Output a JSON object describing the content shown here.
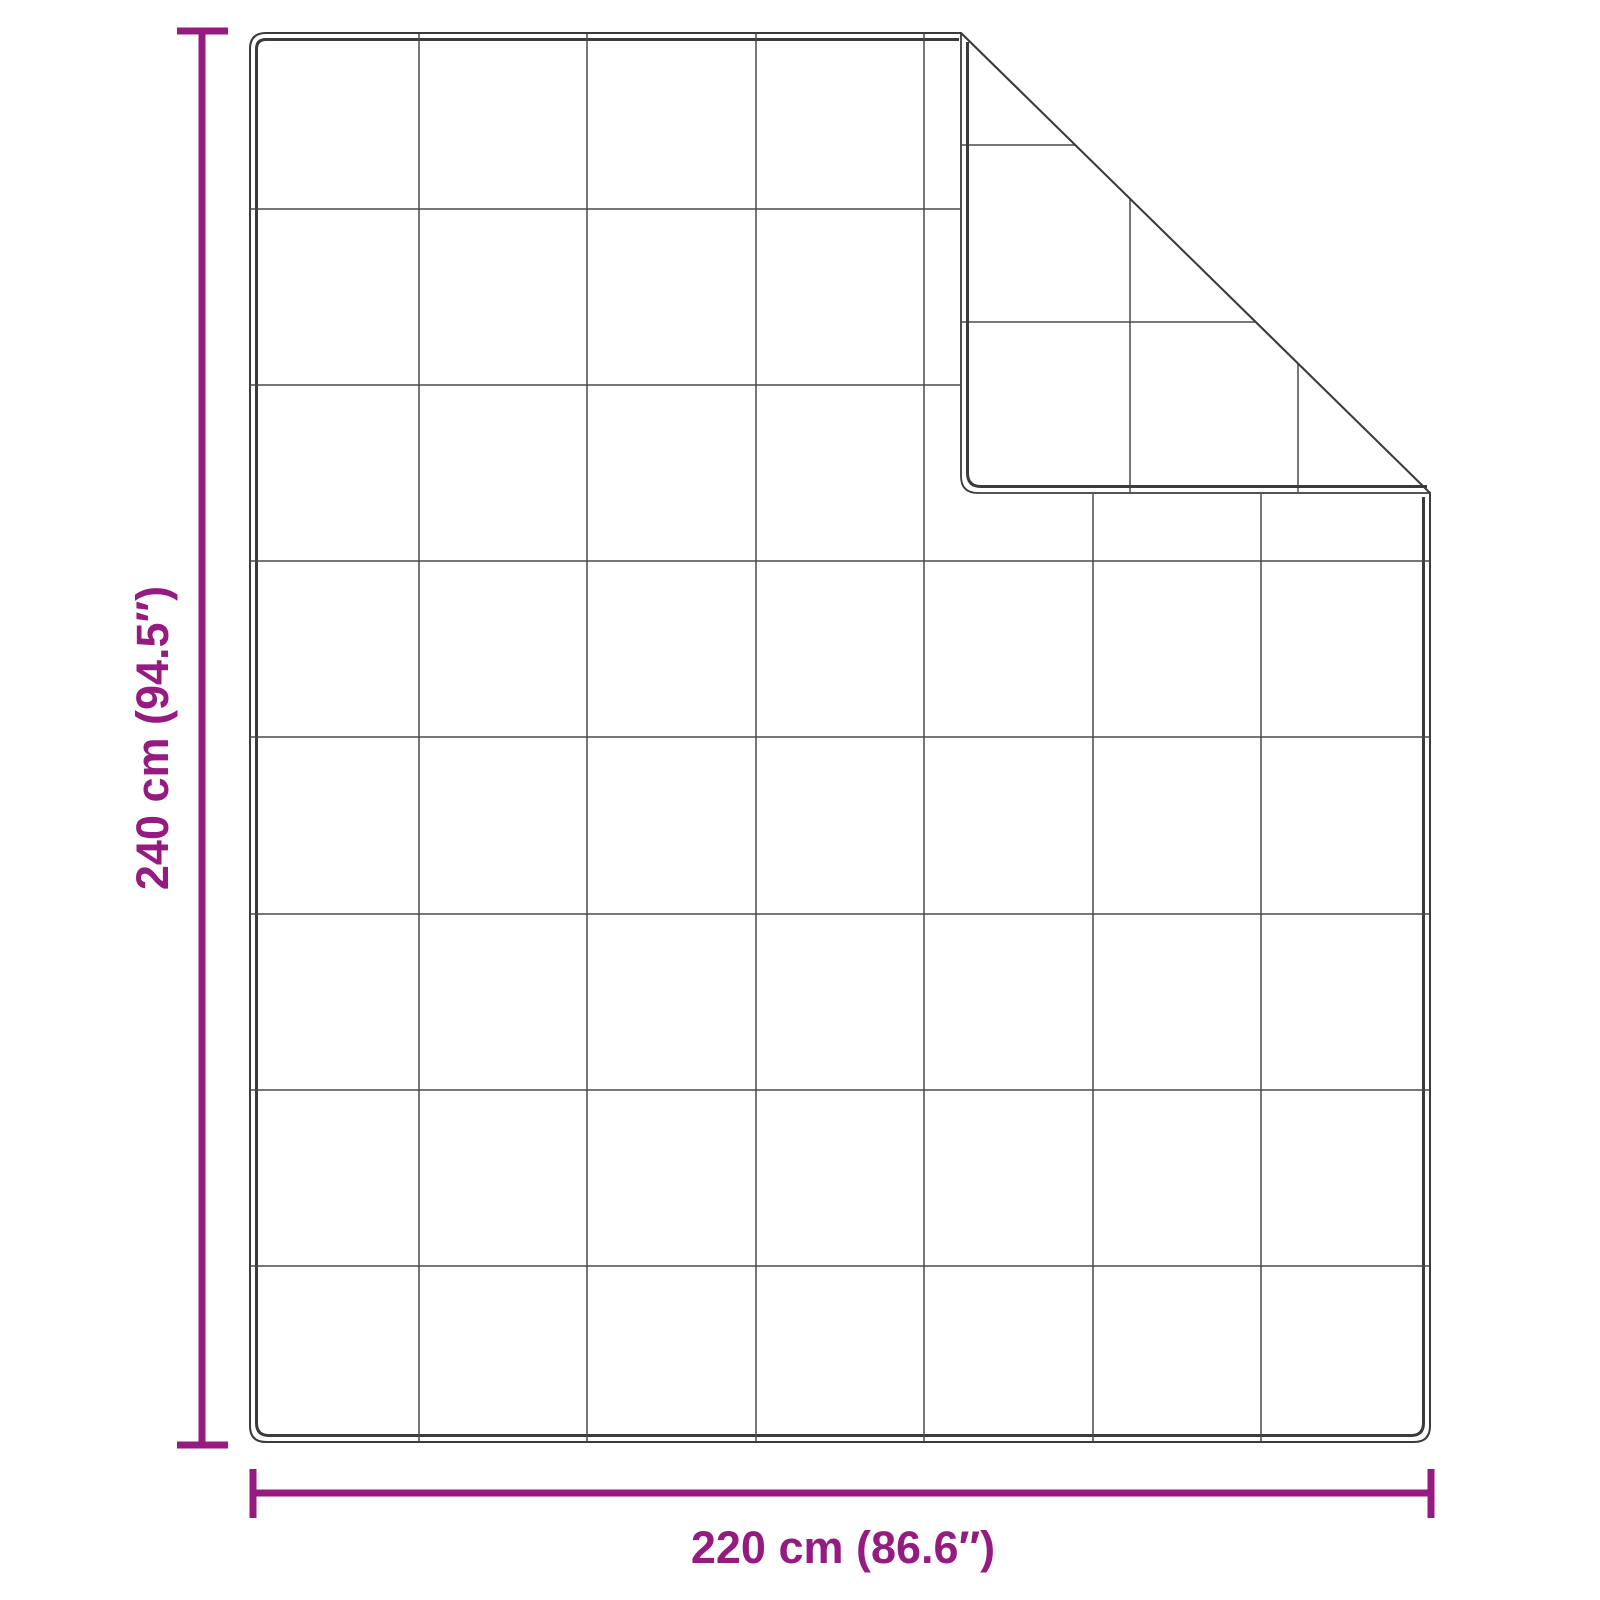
{
  "figure": {
    "background_color": "#ffffff",
    "outline_color": "#3b3b3b",
    "grid_color": "#4a4a4a",
    "accent_color": "#951b81",
    "quilt_grid": {
      "columns": 7,
      "rows": 8
    },
    "dimensions": {
      "height": {
        "label": "240 cm (94.5″)",
        "cm": 240,
        "inches": 94.5
      },
      "width": {
        "label": "220 cm (86.6″)",
        "cm": 220,
        "inches": 86.6
      }
    }
  }
}
